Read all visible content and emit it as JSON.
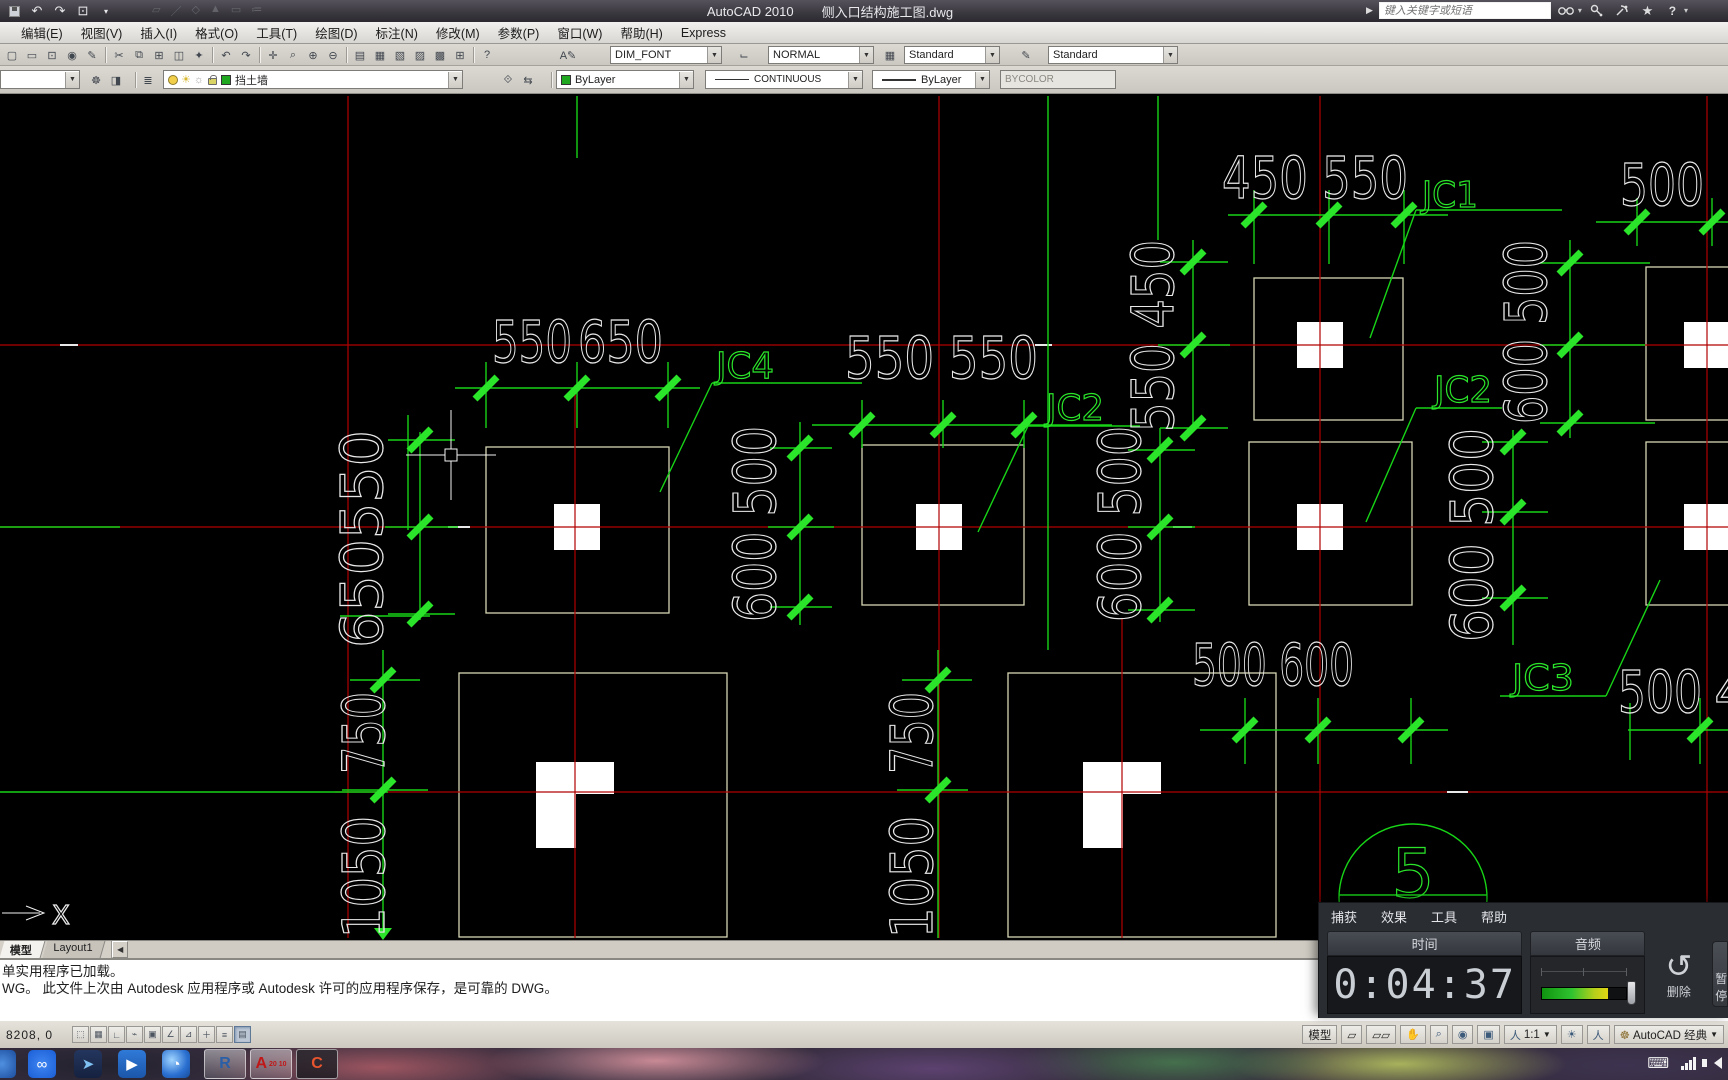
{
  "window": {
    "app_title": "AutoCAD 2010",
    "doc_title": "侧入口结构施工图.dwg"
  },
  "search": {
    "placeholder": "键入关键字或短语"
  },
  "menus": [
    "编辑(E)",
    "视图(V)",
    "插入(I)",
    "格式(O)",
    "工具(T)",
    "绘图(D)",
    "标注(N)",
    "修改(M)",
    "参数(P)",
    "窗口(W)",
    "帮助(H)",
    "Express"
  ],
  "styles_toolbar": {
    "text_style": "DIM_FONT",
    "dim_style": "NORMAL",
    "table_style": "Standard",
    "mleader_style": "Standard"
  },
  "layers_toolbar": {
    "current_layer": "挡土墙",
    "color": "ByLayer",
    "linetype": "CONTINUOUS",
    "lineweight": "ByLayer",
    "plot_style": "BYCOLOR"
  },
  "icon_glyphs": {
    "qat": [
      {
        "n": "undo-icon",
        "g": "↶"
      },
      {
        "n": "redo-icon",
        "g": "↷"
      },
      {
        "n": "qat-dropdown-icon",
        "g": "▾"
      }
    ],
    "ghost": [
      {
        "n": "ghost-icon-1",
        "g": "▱"
      },
      {
        "n": "ghost-icon-2",
        "g": "／"
      },
      {
        "n": "ghost-icon-3",
        "g": "◇"
      },
      {
        "n": "ghost-icon-4",
        "g": "▲"
      },
      {
        "n": "ghost-icon-5",
        "g": "▭"
      },
      {
        "n": "ghost-icon-6",
        "g": "≔"
      }
    ],
    "std": [
      {
        "n": "qnew-icon",
        "g": "▢"
      },
      {
        "n": "open-icon",
        "g": "▭"
      },
      {
        "n": "plot-icon",
        "g": "⊡"
      },
      {
        "n": "publish-icon",
        "g": "◉"
      },
      {
        "n": "edit-icon",
        "g": "✎"
      },
      {
        "n": "sep",
        "g": "|"
      },
      {
        "n": "cut-icon",
        "g": "✂"
      },
      {
        "n": "copy-icon",
        "g": "⧉"
      },
      {
        "n": "paste-icon",
        "g": "⊞"
      },
      {
        "n": "paste-special-icon",
        "g": "◫"
      },
      {
        "n": "match-properties-icon",
        "g": "✦"
      },
      {
        "n": "sep",
        "g": "|"
      },
      {
        "n": "undo-icon",
        "g": "↶"
      },
      {
        "n": "redo-icon",
        "g": "↷"
      },
      {
        "n": "sep",
        "g": "|"
      },
      {
        "n": "pan-icon",
        "g": "✛"
      },
      {
        "n": "zoom-realtime-icon",
        "g": "⌕"
      },
      {
        "n": "zoom-window-icon",
        "g": "⊕"
      },
      {
        "n": "zoom-previous-icon",
        "g": "⊖"
      },
      {
        "n": "sep",
        "g": "|"
      },
      {
        "n": "properties-icon",
        "g": "▤"
      },
      {
        "n": "designcenter-icon",
        "g": "▦"
      },
      {
        "n": "toolpalettes-icon",
        "g": "▧"
      },
      {
        "n": "sheetset-icon",
        "g": "▨"
      },
      {
        "n": "markup-icon",
        "g": "▩"
      },
      {
        "n": "calculator-icon",
        "g": "⊞"
      },
      {
        "n": "sep",
        "g": "|"
      },
      {
        "n": "help-icon",
        "g": "?"
      }
    ],
    "layer_tools": [
      {
        "n": "layer-settings-icon",
        "g": "☸"
      },
      {
        "n": "layer-states-icon",
        "g": "◨"
      }
    ],
    "layer_mgr": [
      {
        "n": "layer-manager-icon",
        "g": "≣"
      }
    ],
    "layer_after": [
      {
        "n": "make-current-icon",
        "g": "⟐"
      },
      {
        "n": "layer-previous-icon",
        "g": "⇆"
      }
    ]
  },
  "drawing": {
    "colors": {
      "grid_red": "#b00000",
      "dim_green": "#17d417",
      "tick_green": "#2ae52a",
      "text_white": "#e9e9e9",
      "foundation": "#d6d6b4"
    },
    "texts": [
      {
        "t": "550",
        "x": 492,
        "y": 362,
        "r": 0,
        "l": 80,
        "s": 58,
        "c": "w"
      },
      {
        "t": "650",
        "x": 578,
        "y": 362,
        "r": 0,
        "l": 85,
        "s": 58,
        "c": "w"
      },
      {
        "t": "550 550",
        "x": 845,
        "y": 378,
        "r": 0,
        "l": 193,
        "s": 58,
        "c": "w"
      },
      {
        "t": "450 550",
        "x": 1222,
        "y": 198,
        "r": 0,
        "l": 186,
        "s": 58,
        "c": "w"
      },
      {
        "t": "500",
        "x": 1620,
        "y": 205,
        "r": 0,
        "l": 84,
        "s": 58,
        "c": "w"
      },
      {
        "t": "500 600",
        "x": 1192,
        "y": 685,
        "r": 0,
        "l": 162,
        "s": 58,
        "c": "w"
      },
      {
        "t": "500",
        "x": 1618,
        "y": 712,
        "r": 0,
        "l": 84,
        "s": 58,
        "c": "w"
      },
      {
        "t": "4",
        "x": 1714,
        "y": 712,
        "r": 0,
        "l": 30,
        "s": 58,
        "c": "w"
      },
      {
        "t": "JC4",
        "x": 716,
        "y": 378,
        "r": 0,
        "l": 58,
        "s": 36,
        "c": "g"
      },
      {
        "t": "JC2",
        "x": 1046,
        "y": 420,
        "r": 0,
        "l": 58,
        "s": 36,
        "c": "g"
      },
      {
        "t": "JC1",
        "x": 1422,
        "y": 207,
        "r": 0,
        "l": 56,
        "s": 36,
        "c": "g"
      },
      {
        "t": "JC2",
        "x": 1434,
        "y": 402,
        "r": 0,
        "l": 58,
        "s": 36,
        "c": "g"
      },
      {
        "t": "JC3",
        "x": 1512,
        "y": 690,
        "r": 0,
        "l": 62,
        "s": 36,
        "c": "g"
      },
      {
        "t": "650550",
        "x": 382,
        "y": 648,
        "r": -90,
        "l": 218,
        "s": 58,
        "c": "w"
      },
      {
        "t": "600 500",
        "x": 775,
        "y": 622,
        "r": -90,
        "l": 196,
        "s": 58,
        "c": "w"
      },
      {
        "t": "550 450",
        "x": 1173,
        "y": 432,
        "r": -90,
        "l": 192,
        "s": 58,
        "c": "w"
      },
      {
        "t": "600 500",
        "x": 1140,
        "y": 622,
        "r": -90,
        "l": 196,
        "s": 58,
        "c": "w"
      },
      {
        "t": "600 500",
        "x": 1546,
        "y": 424,
        "r": -90,
        "l": 184,
        "s": 58,
        "c": "w"
      },
      {
        "t": "600 500",
        "x": 1492,
        "y": 642,
        "r": -90,
        "l": 214,
        "s": 58,
        "c": "w"
      },
      {
        "t": "750",
        "x": 384,
        "y": 774,
        "r": -90,
        "l": 82,
        "s": 58,
        "c": "w"
      },
      {
        "t": "1050",
        "x": 384,
        "y": 938,
        "r": -90,
        "l": 122,
        "s": 58,
        "c": "w"
      },
      {
        "t": "750",
        "x": 932,
        "y": 774,
        "r": -90,
        "l": 82,
        "s": 58,
        "c": "w"
      },
      {
        "t": "1050",
        "x": 932,
        "y": 938,
        "r": -90,
        "l": 122,
        "s": 58,
        "c": "w"
      },
      {
        "t": "5",
        "x": 1413,
        "y": 897,
        "r": 0,
        "l": 34,
        "s": 68,
        "c": "g",
        "a": "m"
      }
    ]
  },
  "tabs": {
    "model": "模型",
    "layout1": "Layout1"
  },
  "command": {
    "line1": "单实用程序已加载。",
    "line2": "WG。  此文件上次由 Autodesk 应用程序或 Autodesk 许可的应用程序保存，是可靠的 DWG。"
  },
  "statusbar": {
    "coords": "8208, 0",
    "model_label": "模型",
    "annotation_scale": "1:1",
    "workspace": "AutoCAD 经典"
  },
  "recorder": {
    "menu_capture": "捕获",
    "menu_effects": "效果",
    "menu_tools": "工具",
    "menu_help": "帮助",
    "time_label": "时间",
    "time_value": "0:04:37",
    "audio_label": "音频",
    "delete_label": "删除",
    "pause_partial": "暂停"
  },
  "taskbar": {
    "revit_label": "R",
    "autocad_label": "A",
    "autocad_badge": "20 10",
    "camtasia_label": "C"
  }
}
